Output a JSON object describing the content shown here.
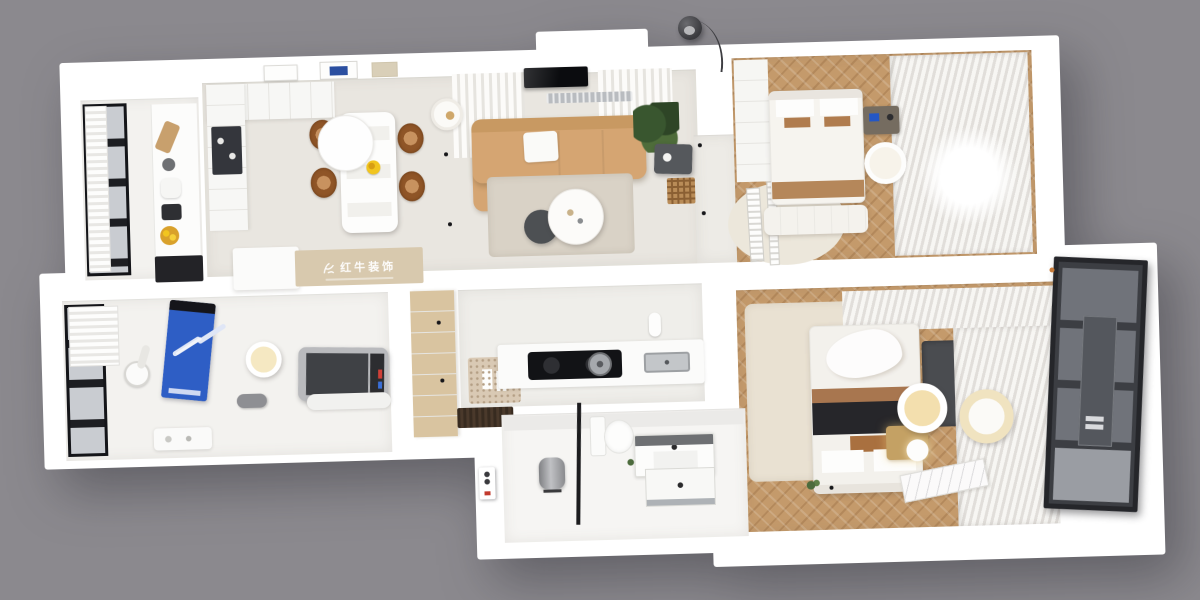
{
  "scene": {
    "description": "photorealistic 3D top-down floor-plan render of a two-bedroom apartment on a gray backdrop",
    "background_color": "#8b898e",
    "watermark": {
      "logo": "red-bull-figure-logo",
      "text": "红牛装饰"
    }
  },
  "colors": {
    "bg": "#8b898e",
    "wall": "#ffffff",
    "floor": "#e9e6e0",
    "floor_white": "#f3f2ef",
    "wood": "#c49a6b",
    "sofa": "#d5a572",
    "sofa_dark": "#c89962",
    "rug": "#d9d2c6",
    "rug_cream": "#e9e1d2",
    "blue": "#2e5ec5",
    "rattan": "#8f5527",
    "rattan_light": "#c8925f",
    "gold": "#c4a164",
    "cream": "#f3dfae",
    "frame_dark": "#1d1e22",
    "glass_door": "#3c3e43",
    "steel": "#aeb2b6",
    "label_red": "#c23b2e",
    "island_beige": "#d8c9ae"
  },
  "rooms": [
    {
      "name": "kitchen-balcony",
      "items": [
        "black-framed-window",
        "roman-shade",
        "counter",
        "cutting-board",
        "kettle",
        "coffee-machine",
        "fruit-bowl",
        "dark-cabinet"
      ]
    },
    {
      "name": "kitchen-dining",
      "items": [
        "wall-cabinets",
        "glass-display-cabinet",
        "artwork-frames",
        "dining-table",
        "round-tabletop",
        "rattan-chairs",
        "fruit-plate",
        "island-counter",
        "watermark-band"
      ]
    },
    {
      "name": "living-room",
      "items": [
        "tv",
        "ac-vent",
        "sheer-curtains",
        "sofa",
        "chaise",
        "white-throw",
        "floor-lamp",
        "plant",
        "side-table",
        "lattice-screen",
        "area-rug",
        "round-coffee-table",
        "stool",
        "downlights"
      ]
    },
    {
      "name": "bedroom-top-right",
      "items": [
        "wardrobe",
        "double-bed",
        "pillows",
        "brown-runner",
        "bench",
        "nightstand",
        "round-side-table",
        "organic-rug",
        "striped-runners",
        "window-curtains"
      ]
    },
    {
      "name": "bedroom-bottom-right",
      "items": [
        "double-bed",
        "black-throw",
        "pillows",
        "gold-nightstand",
        "sphere-lamp",
        "pendant-light-white",
        "pendant-light-cream",
        "tv-panel",
        "window-curtains",
        "cream-rug",
        "marble-doormat",
        "plant-sprig"
      ]
    },
    {
      "name": "gym-balcony",
      "items": [
        "black-framed-window",
        "roman-shade",
        "exercise-bike",
        "blue-yoga-mat",
        "dumbbell",
        "ceiling-light",
        "foam-roller",
        "treadmill",
        "shelf"
      ]
    },
    {
      "name": "hall-kitchenette",
      "items": [
        "wood-cabinet",
        "slipper-mat",
        "slippers",
        "entry-rug",
        "counter",
        "induction-cooktop",
        "pot",
        "paper-towel",
        "sink",
        "downlights"
      ]
    },
    {
      "name": "bathroom",
      "items": [
        "water-heater",
        "riser-pipe",
        "toilet",
        "vanity-sink",
        "shower-tray"
      ]
    },
    {
      "name": "entry",
      "items": [
        "dark-glass-sliding-door",
        "utility-panel"
      ]
    }
  ],
  "exterior": {
    "lamp": "arc-floor-lamp"
  }
}
